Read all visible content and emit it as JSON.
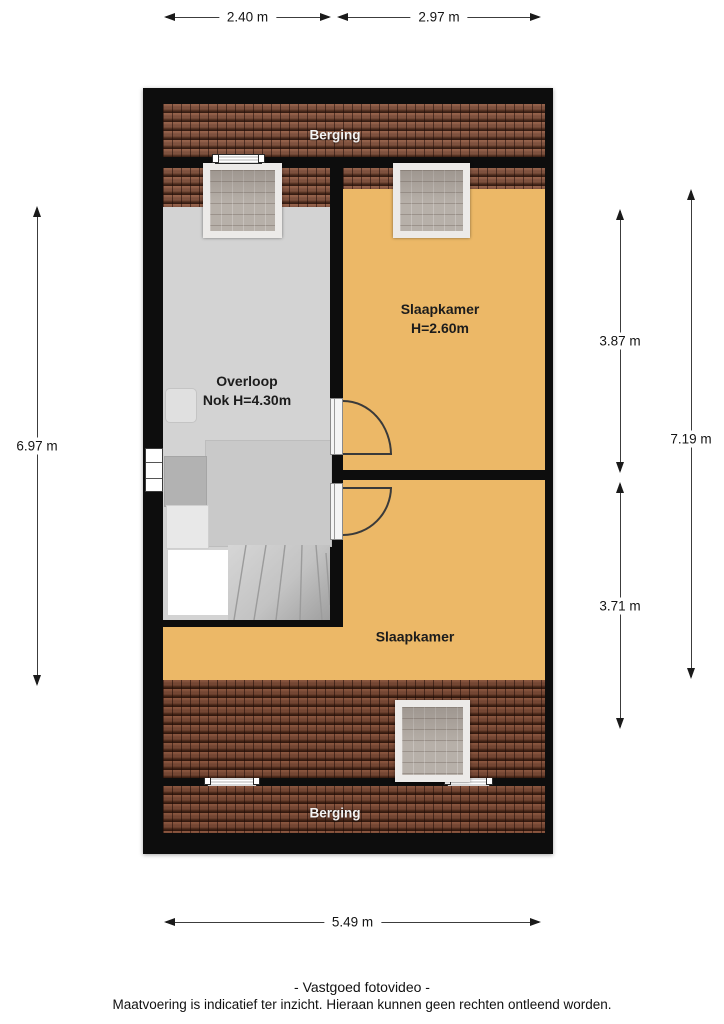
{
  "plan": {
    "type": "floorplan-attic-floor"
  },
  "dimensions": {
    "top": [
      "2.40 m",
      "2.97 m"
    ],
    "bottom": "5.49 m",
    "left": "6.97 m",
    "right_upper": "3.87 m",
    "right_lower": "3.71 m",
    "right_total": "7.19 m"
  },
  "rooms": {
    "berging_top": "Berging",
    "berging_bottom": "Berging",
    "slaapkamer_top": {
      "label": "Slaapkamer",
      "height": "H=2.60m"
    },
    "slaapkamer_bottom": {
      "label": "Slaapkamer"
    },
    "overloop": {
      "label": "Overloop",
      "note": "Nok H=4.30m"
    }
  },
  "footer": {
    "line1": "- Vastgoed fotovideo -",
    "line2": "Maatvoering is indicatief ter inzicht. Hieraan kunnen geen rechten ontleend worden."
  },
  "colors": {
    "wall": "#0d0d0d",
    "roof_tiles": "#7e513e",
    "roof_tiles_dark": "#6f4533",
    "room_orange": "#ecb867",
    "room_gray": "#d3d3d3",
    "skylight_glass": "#b7b0a9",
    "skylight_frame": "#eceae8",
    "dimension_line": "#3c3c3c"
  }
}
